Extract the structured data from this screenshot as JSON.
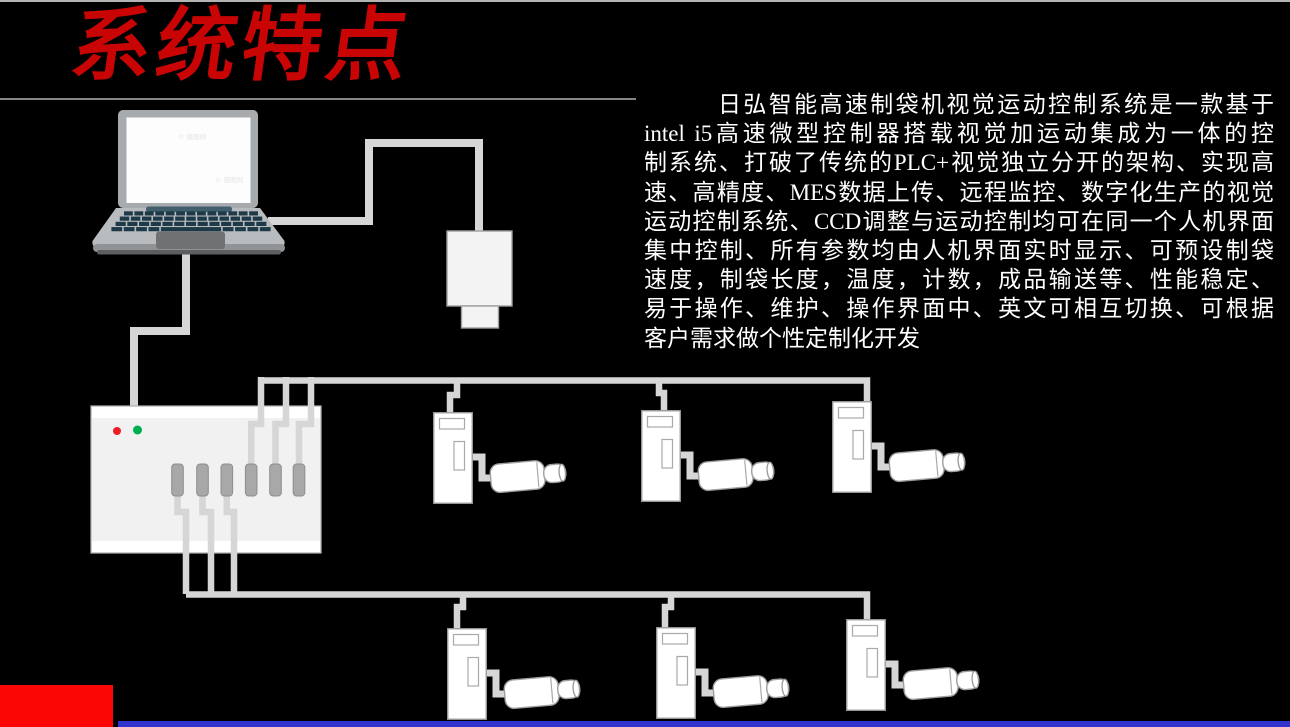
{
  "slide": {
    "title": "系统特点",
    "colors": {
      "background": "#000000",
      "title": "#c80404",
      "body_text": "#ffffff",
      "accent_block": "#fb0505",
      "footer_bar": "#3232cc",
      "cable": "#d6d6d6",
      "device_fill": "#ffffff",
      "device_stroke": "#9e9e9e",
      "controller_fill": "#f1f1f1",
      "led_red": "#ee1c25",
      "led_green": "#00b050",
      "laptop_bezel": "#a7abad",
      "laptop_screen": "#fdfdfd",
      "laptop_body": "#b9bcbe",
      "laptop_key": "#1e3a49",
      "laptop_hinge": "#415f6d",
      "laptop_trackpad": "#6f7173"
    }
  },
  "paragraph": {
    "lines": [
      "日弘智能高速制袋机视觉运动控制系统是一款基于",
      "intel i5高速微型控制器搭载视觉加运动集成为一体的控",
      "制系统、打破了传统的PLC+视觉独立分开的架构、实现高",
      "速、高精度、MES数据上传、远程监控、数字化生产的视觉",
      "运动控制系统、CCD调整与运动控制均可在同一个人机界面",
      "集中控制、所有参数均由人机界面实时显示、可预设制袋",
      "速度，制袋长度，温度，计数，成品输送等、性能稳定、",
      "易于操作、维护、操作界面中、英文可相互切换、可根据",
      "客户需求做个性定制化开发"
    ],
    "full_text": "日弘智能高速制袋机视觉运动控制系统是一款基于intel i5高速微型控制器搭载视觉加运动集成为一体的控制系统、打破了传统的PLC+视觉独立分开的架构、实现高速、高精度、MES数据上传、远程监控、数字化生产的视觉运动控制系统、CCD调整与运动控制均可在同一个人机界面集中控制、所有参数均由人机界面实时显示、可预设制袋速度，制袋长度，温度，计数，成品输送等、性能稳定、易于操作、维护、操作界面中、英文可相互切换、可根据客户需求做个性定制化开发"
  },
  "diagram": {
    "laptop": {
      "label": "laptop",
      "watermark": "© 摄图网"
    },
    "camera": {
      "label": "vision-camera"
    },
    "controller": {
      "label": "motion-controller",
      "led_colors": [
        "red",
        "green"
      ],
      "port_count": 6
    },
    "servo_drives": {
      "top_row_count": 3,
      "bottom_row_count": 3
    },
    "servo_motors": {
      "count": 6
    }
  }
}
